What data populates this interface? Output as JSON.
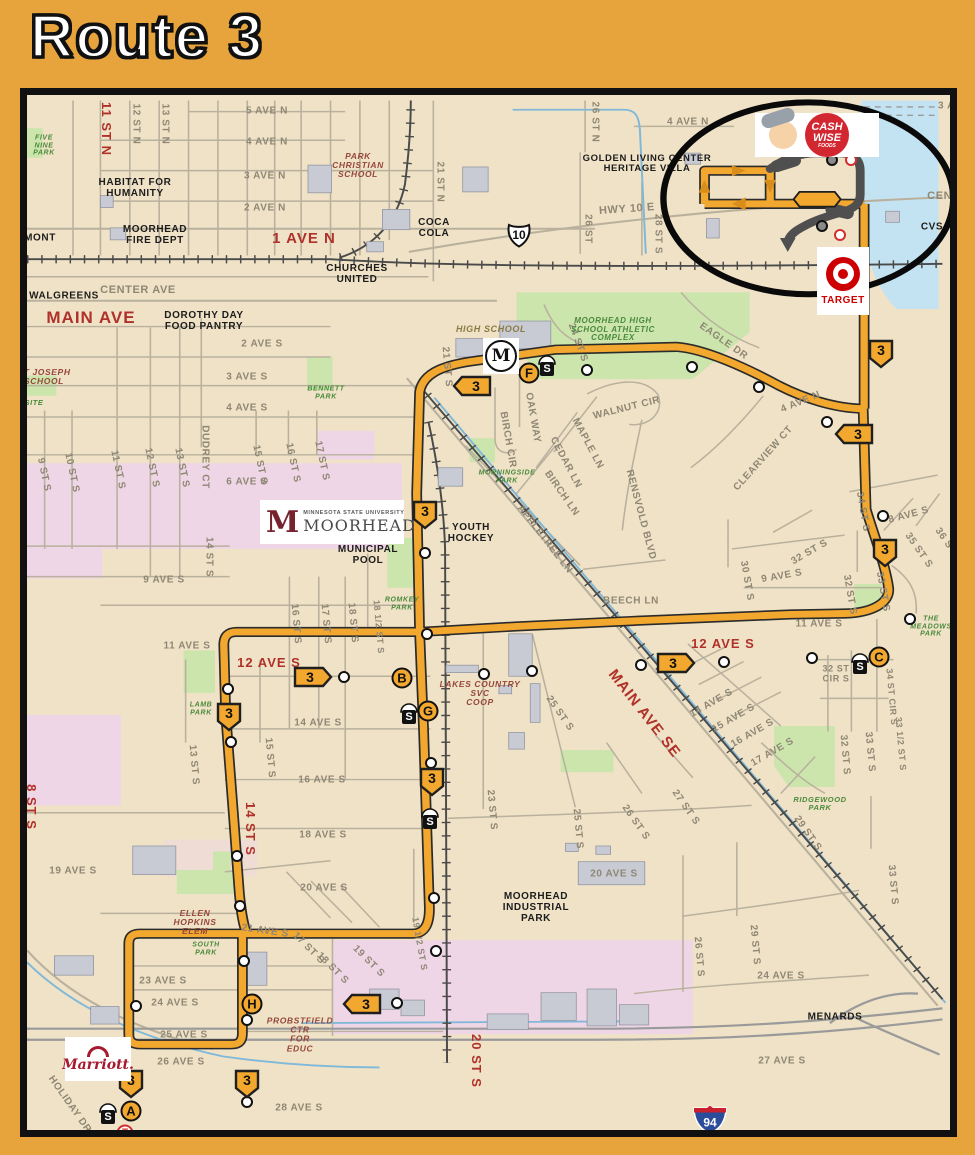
{
  "title": "Route 3",
  "colors": {
    "page_bg": "#E8A43C",
    "map_bg": "#EFE2C6",
    "route_orange": "#F2A72E",
    "water": "#C4E3F2",
    "park_green": "#CBE5AD",
    "campus_pink": "#EFD6E6",
    "red_label": "#B03129",
    "gray_label": "#8F8775",
    "detour_gray": "#4f4f4f"
  },
  "map": {
    "route_number": "3",
    "labels": [
      {
        "t": "1 AVE N",
        "x": 297,
        "y": 232,
        "c": "red",
        "s": 15
      },
      {
        "t": "MAIN AVE",
        "x": 84,
        "y": 311,
        "c": "red",
        "s": 17
      },
      {
        "t": "11 ST N",
        "x": 99,
        "y": 122,
        "c": "red",
        "r": 90,
        "s": 13
      },
      {
        "t": "12 AVE S",
        "x": 262,
        "y": 656,
        "c": "red",
        "s": 13
      },
      {
        "t": "12 AVE S",
        "x": 716,
        "y": 637,
        "c": "red",
        "s": 13
      },
      {
        "t": "MAIN AVE SE",
        "x": 637,
        "y": 707,
        "c": "red",
        "r": 52,
        "s": 15
      },
      {
        "t": "14 ST S",
        "x": 243,
        "y": 822,
        "c": "red",
        "r": 90,
        "s": 13
      },
      {
        "t": "20 ST S",
        "x": 469,
        "y": 1054,
        "c": "red",
        "r": 90,
        "s": 13
      },
      {
        "t": "8 ST S",
        "x": 24,
        "y": 800,
        "c": "red",
        "r": 90,
        "s": 13
      },
      {
        "t": "5 AVE N",
        "x": 260,
        "y": 105
      },
      {
        "t": "4 AVE N",
        "x": 260,
        "y": 136
      },
      {
        "t": "3 AVE N",
        "x": 258,
        "y": 170
      },
      {
        "t": "2 AVE N",
        "x": 258,
        "y": 202
      },
      {
        "t": "CENTER AVE",
        "x": 131,
        "y": 284,
        "s": 11
      },
      {
        "t": "CENTER AVE",
        "x": 958,
        "y": 190,
        "s": 11
      },
      {
        "t": "HWY 10 E",
        "x": 620,
        "y": 203,
        "r": -4,
        "s": 11
      },
      {
        "t": "12 ST N",
        "x": 128,
        "y": 117,
        "r": 90
      },
      {
        "t": "13 ST N",
        "x": 157,
        "y": 117,
        "r": 90
      },
      {
        "t": "21 ST N",
        "x": 432,
        "y": 175,
        "r": 90
      },
      {
        "t": "26 ST N",
        "x": 587,
        "y": 115,
        "r": 90
      },
      {
        "t": "26 ST",
        "x": 580,
        "y": 222,
        "r": 90
      },
      {
        "t": "28 ST S",
        "x": 650,
        "y": 227,
        "r": 90
      },
      {
        "t": "4 AVE N",
        "x": 681,
        "y": 116
      },
      {
        "t": "3 AVE N",
        "x": 952,
        "y": 100
      },
      {
        "t": "2 AVE S",
        "x": 255,
        "y": 338
      },
      {
        "t": "3 AVE S",
        "x": 240,
        "y": 371
      },
      {
        "t": "4 AVE S",
        "x": 240,
        "y": 402
      },
      {
        "t": "6 AVE S",
        "x": 240,
        "y": 476
      },
      {
        "t": "9 AVE S",
        "x": 157,
        "y": 574
      },
      {
        "t": "11 AVE S",
        "x": 180,
        "y": 640
      },
      {
        "t": "DUDREY CT",
        "x": 197,
        "y": 450,
        "r": 90
      },
      {
        "t": "9 ST S",
        "x": 36,
        "y": 468,
        "r": 78
      },
      {
        "t": "10 ST S",
        "x": 64,
        "y": 466,
        "r": 78
      },
      {
        "t": "11 ST S",
        "x": 110,
        "y": 463,
        "r": 78
      },
      {
        "t": "12 ST S",
        "x": 144,
        "y": 461,
        "r": 78
      },
      {
        "t": "13 ST S",
        "x": 174,
        "y": 461,
        "r": 78
      },
      {
        "t": "15 ST S",
        "x": 252,
        "y": 458,
        "r": 78
      },
      {
        "t": "16 ST S",
        "x": 285,
        "y": 456,
        "r": 78
      },
      {
        "t": "17 ST S",
        "x": 314,
        "y": 454,
        "r": 78
      },
      {
        "t": "14 ST S",
        "x": 201,
        "y": 550,
        "r": 90
      },
      {
        "t": "16 ST S",
        "x": 288,
        "y": 617,
        "r": 85
      },
      {
        "t": "17 ST S",
        "x": 318,
        "y": 617,
        "r": 85
      },
      {
        "t": "18 ST S",
        "x": 345,
        "y": 616,
        "r": 85
      },
      {
        "t": "18 1/2 ST S",
        "x": 371,
        "y": 620,
        "r": 85,
        "s": 9
      },
      {
        "t": "21 ST S",
        "x": 439,
        "y": 360,
        "r": 85
      },
      {
        "t": "24 ST S",
        "x": 570,
        "y": 336,
        "r": 70
      },
      {
        "t": "OAK WAY",
        "x": 525,
        "y": 411,
        "r": 80
      },
      {
        "t": "BIRCH CIR",
        "x": 500,
        "y": 433,
        "r": 80
      },
      {
        "t": "WALNUT CIR",
        "x": 620,
        "y": 402,
        "r": -14
      },
      {
        "t": "MAPLE LN",
        "x": 580,
        "y": 437,
        "r": 62
      },
      {
        "t": "CEDAR LN",
        "x": 558,
        "y": 456,
        "r": 62
      },
      {
        "t": "BIRCH LN",
        "x": 554,
        "y": 487,
        "r": 55
      },
      {
        "t": "RENSVOLD BLVD",
        "x": 633,
        "y": 508,
        "r": 75
      },
      {
        "t": "APPLETREE LN",
        "x": 537,
        "y": 533,
        "r": 52
      },
      {
        "t": "BEECH LN",
        "x": 624,
        "y": 595
      },
      {
        "t": "EAGLE DR",
        "x": 716,
        "y": 335,
        "r": 35
      },
      {
        "t": "4 AVE N",
        "x": 794,
        "y": 396,
        "r": -22
      },
      {
        "t": "CLEARVIEW CT",
        "x": 757,
        "y": 452,
        "r": -48
      },
      {
        "t": "34 ST S",
        "x": 855,
        "y": 505,
        "r": 80
      },
      {
        "t": "8 AVE S",
        "x": 902,
        "y": 509,
        "r": -15
      },
      {
        "t": "35 ST S",
        "x": 911,
        "y": 544,
        "r": 55
      },
      {
        "t": "36 ST S",
        "x": 941,
        "y": 539,
        "r": 55
      },
      {
        "t": "32 ST S",
        "x": 803,
        "y": 546,
        "r": -30
      },
      {
        "t": "30 ST S",
        "x": 739,
        "y": 574,
        "r": 80
      },
      {
        "t": "9 AVE S",
        "x": 775,
        "y": 570,
        "r": -10
      },
      {
        "t": "33 ST S",
        "x": 875,
        "y": 585,
        "r": 80
      },
      {
        "t": "32 ST S",
        "x": 842,
        "y": 588,
        "r": 80
      },
      {
        "t": "11 AVE S",
        "x": 812,
        "y": 618
      },
      {
        "t": "32 ST\nCIR S",
        "x": 829,
        "y": 667,
        "s": 9
      },
      {
        "t": "34 ST CIR S",
        "x": 884,
        "y": 690,
        "r": 85,
        "s": 9
      },
      {
        "t": "33 1/2 ST S",
        "x": 893,
        "y": 737,
        "r": 85,
        "s": 9
      },
      {
        "t": "33 ST S",
        "x": 862,
        "y": 745,
        "r": 85
      },
      {
        "t": "32 ST S",
        "x": 837,
        "y": 748,
        "r": 85
      },
      {
        "t": "14 AVE S",
        "x": 705,
        "y": 697,
        "r": -30
      },
      {
        "t": "15 AVE S",
        "x": 727,
        "y": 712,
        "r": -30
      },
      {
        "t": "16 AVE S",
        "x": 746,
        "y": 727,
        "r": -30
      },
      {
        "t": "17 AVE S",
        "x": 766,
        "y": 746,
        "r": -30
      },
      {
        "t": "27 ST S",
        "x": 678,
        "y": 801,
        "r": 55
      },
      {
        "t": "26 ST S",
        "x": 628,
        "y": 816,
        "r": 55
      },
      {
        "t": "25 ST S",
        "x": 552,
        "y": 707,
        "r": 55
      },
      {
        "t": "25 ST S",
        "x": 570,
        "y": 822,
        "r": 85
      },
      {
        "t": "23 ST S",
        "x": 484,
        "y": 803,
        "r": 85
      },
      {
        "t": "29 ST S",
        "x": 800,
        "y": 827,
        "r": 55
      },
      {
        "t": "33 ST S",
        "x": 885,
        "y": 878,
        "r": 85
      },
      {
        "t": "14 AVE S",
        "x": 311,
        "y": 717
      },
      {
        "t": "16 AVE S",
        "x": 315,
        "y": 774
      },
      {
        "t": "15 ST S",
        "x": 262,
        "y": 751,
        "r": 85
      },
      {
        "t": "13 ST S",
        "x": 186,
        "y": 758,
        "r": 85
      },
      {
        "t": "18 AVE S",
        "x": 316,
        "y": 829
      },
      {
        "t": "19 AVE S",
        "x": 66,
        "y": 865
      },
      {
        "t": "20 AVE S",
        "x": 317,
        "y": 882
      },
      {
        "t": "20 AVE S",
        "x": 607,
        "y": 868
      },
      {
        "t": "21 AVE S",
        "x": 258,
        "y": 925,
        "r": 8
      },
      {
        "t": "17 ST S",
        "x": 301,
        "y": 942,
        "r": 45
      },
      {
        "t": "18 ST S",
        "x": 325,
        "y": 962,
        "r": 45
      },
      {
        "t": "19 ST S",
        "x": 361,
        "y": 955,
        "r": 45
      },
      {
        "t": "19 1/2 ST S",
        "x": 412,
        "y": 937,
        "r": 80,
        "s": 9
      },
      {
        "t": "23 AVE S",
        "x": 156,
        "y": 975
      },
      {
        "t": "24 AVE S",
        "x": 168,
        "y": 997
      },
      {
        "t": "25 AVE S",
        "x": 177,
        "y": 1029
      },
      {
        "t": "26 AVE S",
        "x": 174,
        "y": 1056
      },
      {
        "t": "28 AVE S",
        "x": 292,
        "y": 1102
      },
      {
        "t": "HOLIDAY DR",
        "x": 62,
        "y": 1098,
        "r": 55
      },
      {
        "t": "26 ST S",
        "x": 691,
        "y": 950,
        "r": 85
      },
      {
        "t": "29 ST S",
        "x": 747,
        "y": 938,
        "r": 85
      },
      {
        "t": "24 AVE S",
        "x": 774,
        "y": 970
      },
      {
        "t": "27 AVE S",
        "x": 775,
        "y": 1055
      },
      {
        "t": "HABITAT FOR\nHUMANITY",
        "x": 128,
        "y": 182,
        "c": "b"
      },
      {
        "t": "MOORHEAD\nFIRE DEPT",
        "x": 148,
        "y": 229,
        "c": "b"
      },
      {
        "t": "CHURCHES\nUNITED",
        "x": 350,
        "y": 268,
        "c": "b"
      },
      {
        "t": "COCA\nCOLA",
        "x": 427,
        "y": 222,
        "c": "b"
      },
      {
        "t": "GOLDEN LIVING CENTER\nHERITAGE VILLA",
        "x": 640,
        "y": 157,
        "c": "b",
        "s": 9.5
      },
      {
        "t": "DOROTHY DAY\nFOOD PANTRY",
        "x": 197,
        "y": 315,
        "c": "b"
      },
      {
        "t": "WALGREENS",
        "x": 57,
        "y": 290,
        "c": "b"
      },
      {
        "t": "MONT",
        "x": 33,
        "y": 232,
        "c": "b"
      },
      {
        "t": "YOUTH\nHOCKEY",
        "x": 464,
        "y": 527,
        "c": "b"
      },
      {
        "t": "MUNICIPAL\nPOOL",
        "x": 361,
        "y": 549,
        "c": "b"
      },
      {
        "t": "MOORHEAD\nINDUSTRIAL\nPARK",
        "x": 529,
        "y": 901,
        "c": "b"
      },
      {
        "t": "MENARDS",
        "x": 828,
        "y": 1011,
        "c": "b"
      },
      {
        "t": "CVS",
        "x": 925,
        "y": 221,
        "c": "b"
      },
      {
        "t": "FIVE\nNINE\nPARK",
        "x": 37,
        "y": 139,
        "c": "grn",
        "s": 7
      },
      {
        "t": "BENNETT\nPARK",
        "x": 319,
        "y": 386,
        "c": "grn",
        "s": 7
      },
      {
        "t": "SITE",
        "x": 27,
        "y": 396,
        "c": "grn",
        "s": 7.5
      },
      {
        "t": "MORNINGSIDE\nPARK",
        "x": 500,
        "y": 470,
        "c": "grn",
        "s": 7
      },
      {
        "t": "ROMKEY\nPARK",
        "x": 395,
        "y": 597,
        "c": "grn",
        "s": 7
      },
      {
        "t": "LAMB\nPARK",
        "x": 194,
        "y": 702,
        "c": "grn",
        "s": 7
      },
      {
        "t": "SOUTH\nPARK",
        "x": 199,
        "y": 942,
        "c": "grn",
        "s": 7
      },
      {
        "t": "RIDGEWOOD\nPARK",
        "x": 813,
        "y": 797,
        "c": "grn",
        "s": 7.5
      },
      {
        "t": "THE\nMEADOWS\nPARK",
        "x": 924,
        "y": 620,
        "c": "grn",
        "s": 7
      },
      {
        "t": "MOORHEAD HIGH\nSCHOOL ATHLETIC\nCOMPLEX",
        "x": 606,
        "y": 323,
        "c": "grn",
        "s": 8
      },
      {
        "t": "PARK\nCHRISTIAN\nSCHOOL",
        "x": 351,
        "y": 159,
        "c": "m",
        "s": 8.5
      },
      {
        "t": "ST JOSEPH\nSCHOOL",
        "x": 37,
        "y": 370,
        "c": "m",
        "s": 8.5
      },
      {
        "t": "ELLEN\nHOPKINS\nELEM",
        "x": 188,
        "y": 916,
        "c": "m",
        "s": 8.5
      },
      {
        "t": "PROBSTFIELD\nCTR\nFOR\nEDUC",
        "x": 293,
        "y": 1028,
        "c": "m",
        "s": 8.5
      },
      {
        "t": "LAKES COUNTRY\nSVC\nCOOP",
        "x": 473,
        "y": 687,
        "c": "m",
        "s": 8.5
      },
      {
        "t": "HIGH SCHOOL",
        "x": 484,
        "y": 323,
        "c": "brown",
        "s": 9
      }
    ],
    "lettered_stops": [
      {
        "l": "A",
        "x": 124,
        "y": 1104
      },
      {
        "l": "B",
        "x": 395,
        "y": 671
      },
      {
        "l": "C",
        "x": 872,
        "y": 650
      },
      {
        "l": "F",
        "x": 522,
        "y": 366
      },
      {
        "l": "G",
        "x": 421,
        "y": 704
      },
      {
        "l": "H",
        "x": 245,
        "y": 997
      }
    ],
    "plain_stops": [
      [
        580,
        363
      ],
      [
        685,
        360
      ],
      [
        752,
        380
      ],
      [
        820,
        415
      ],
      [
        876,
        509
      ],
      [
        903,
        612
      ],
      [
        805,
        651
      ],
      [
        717,
        655
      ],
      [
        634,
        658
      ],
      [
        525,
        664
      ],
      [
        477,
        667
      ],
      [
        420,
        627
      ],
      [
        418,
        546
      ],
      [
        337,
        670
      ],
      [
        221,
        682
      ],
      [
        224,
        735
      ],
      [
        424,
        756
      ],
      [
        230,
        849
      ],
      [
        233,
        899
      ],
      [
        237,
        954
      ],
      [
        240,
        1013
      ],
      [
        390,
        996
      ],
      [
        427,
        891
      ],
      [
        429,
        944
      ],
      [
        129,
        999
      ],
      [
        240,
        1095
      ]
    ],
    "gray_stops": [
      [
        825,
        153
      ],
      [
        815,
        219
      ]
    ],
    "ring_stops": [
      [
        844,
        153
      ],
      [
        833,
        228
      ]
    ],
    "shelters": [
      [
        540,
        359
      ],
      [
        402,
        707
      ],
      [
        423,
        812
      ],
      [
        853,
        657
      ],
      [
        101,
        1107
      ]
    ],
    "shields": {
      "down": [
        [
          874,
          347
        ],
        [
          878,
          546
        ],
        [
          418,
          508
        ],
        [
          222,
          710
        ],
        [
          425,
          775
        ],
        [
          124,
          1077
        ],
        [
          240,
          1077
        ]
      ],
      "left": [
        [
          465,
          379
        ],
        [
          847,
          427
        ],
        [
          355,
          997
        ]
      ],
      "right": [
        [
          306,
          670
        ],
        [
          669,
          656
        ]
      ]
    },
    "t_stop": {
      "label": "T",
      "x": 118,
      "y": 1126
    },
    "school_logo": {
      "label": "M",
      "x": 494,
      "y": 349
    },
    "hwy": {
      "us10": {
        "label": "10",
        "x": 512,
        "y": 228
      },
      "i94": {
        "label": "94",
        "x": 703,
        "y": 1112
      }
    },
    "logos": {
      "cashwise": {
        "l1": "CASH",
        "l2": "WISE",
        "l3": "FOODS"
      },
      "target": {
        "label": "TARGET"
      },
      "marriott": {
        "label": "Marriott."
      },
      "msum": {
        "line1": "MINNESOTA STATE UNIVERSITY",
        "line2": "MOORHEAD",
        "m": "M"
      }
    }
  }
}
